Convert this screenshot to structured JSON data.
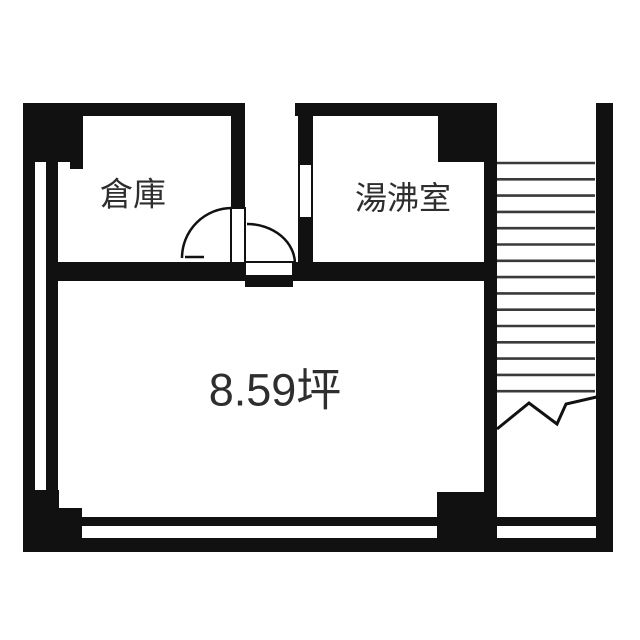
{
  "labels": {
    "storage": "倉庫",
    "kitchenette": "湯沸室",
    "area": "8.59坪"
  },
  "colors": {
    "wall": "#111111",
    "stair_line": "#3a3a3a",
    "text": "#2e2e2e",
    "background": "#ffffff"
  },
  "geometry": {
    "walls": [
      {
        "name": "top-wall-left",
        "x": 23,
        "y": 103,
        "w": 222,
        "h": 13
      },
      {
        "name": "top-left-pillar",
        "x": 23,
        "y": 103,
        "w": 60,
        "h": 59
      },
      {
        "name": "top-left-pillar-step",
        "x": 70,
        "y": 162,
        "w": 13,
        "h": 7
      },
      {
        "name": "left-outer-wall",
        "x": 23,
        "y": 103,
        "w": 12,
        "h": 449
      },
      {
        "name": "left-inner-wall",
        "x": 46,
        "y": 162,
        "w": 12,
        "h": 329
      },
      {
        "name": "bottom-left-block-a",
        "x": 23,
        "y": 490,
        "w": 36,
        "h": 62
      },
      {
        "name": "bottom-left-block-b",
        "x": 23,
        "y": 508,
        "w": 59,
        "h": 44
      },
      {
        "name": "bottom-wall-upper",
        "x": 82,
        "y": 517,
        "w": 518,
        "h": 9
      },
      {
        "name": "bottom-wall-lower",
        "x": 23,
        "y": 538,
        "w": 590,
        "h": 14
      },
      {
        "name": "bottom-right-block",
        "x": 437,
        "y": 492,
        "w": 60,
        "h": 60
      },
      {
        "name": "stair-partition-wall",
        "x": 484,
        "y": 103,
        "w": 13,
        "h": 449
      },
      {
        "name": "top-right-notch",
        "x": 438,
        "y": 103,
        "w": 59,
        "h": 59
      },
      {
        "name": "top-wall-right",
        "x": 295,
        "y": 103,
        "w": 202,
        "h": 13
      },
      {
        "name": "kitchenette-left-wall-upper",
        "x": 298,
        "y": 116,
        "w": 15,
        "h": 49
      },
      {
        "name": "kitchenette-left-wall-lower",
        "x": 298,
        "y": 217,
        "w": 15,
        "h": 64
      },
      {
        "name": "kitchenette-opening-jamb-left",
        "x": 298,
        "y": 165,
        "w": 2,
        "h": 52
      },
      {
        "name": "kitchenette-opening-jamb-right",
        "x": 311,
        "y": 165,
        "w": 2,
        "h": 52
      },
      {
        "name": "room-divider-left",
        "x": 46,
        "y": 262,
        "w": 199,
        "h": 19
      },
      {
        "name": "room-divider-right",
        "x": 293,
        "y": 262,
        "w": 204,
        "h": 19
      },
      {
        "name": "storage-right-wall",
        "x": 231,
        "y": 116,
        "w": 14,
        "h": 92
      },
      {
        "name": "right-outer-wall",
        "x": 596,
        "y": 103,
        "w": 17,
        "h": 449
      },
      {
        "name": "main-door-sill",
        "x": 245,
        "y": 276,
        "w": 48,
        "h": 11
      }
    ],
    "openings": [
      {
        "name": "storage-door-leaf",
        "x": 231,
        "y": 208,
        "w": 14,
        "h": 55
      },
      {
        "name": "main-door-opening",
        "x": 245,
        "y": 262,
        "w": 48,
        "h": 14
      }
    ],
    "door_arcs": [
      {
        "name": "storage-door-arc",
        "d": "M 182 258 A 50 50 0 0 1 232 208"
      },
      {
        "name": "main-door-arc",
        "d": "M 247 224 A 48 40 0 0 1 295 264"
      }
    ],
    "door_tick": {
      "name": "storage-door-tick",
      "x1": 185,
      "y1": 257,
      "x2": 204,
      "y2": 257
    },
    "stairs": {
      "x1": 497,
      "x2": 595,
      "first_y": 163,
      "spacing": 16.3,
      "count": 15,
      "stroke_width": 2.6
    },
    "break_line": {
      "name": "stair-break-line",
      "points": "497,429 529,403 557,424 566,404 601,396",
      "stroke_width": 3
    }
  }
}
